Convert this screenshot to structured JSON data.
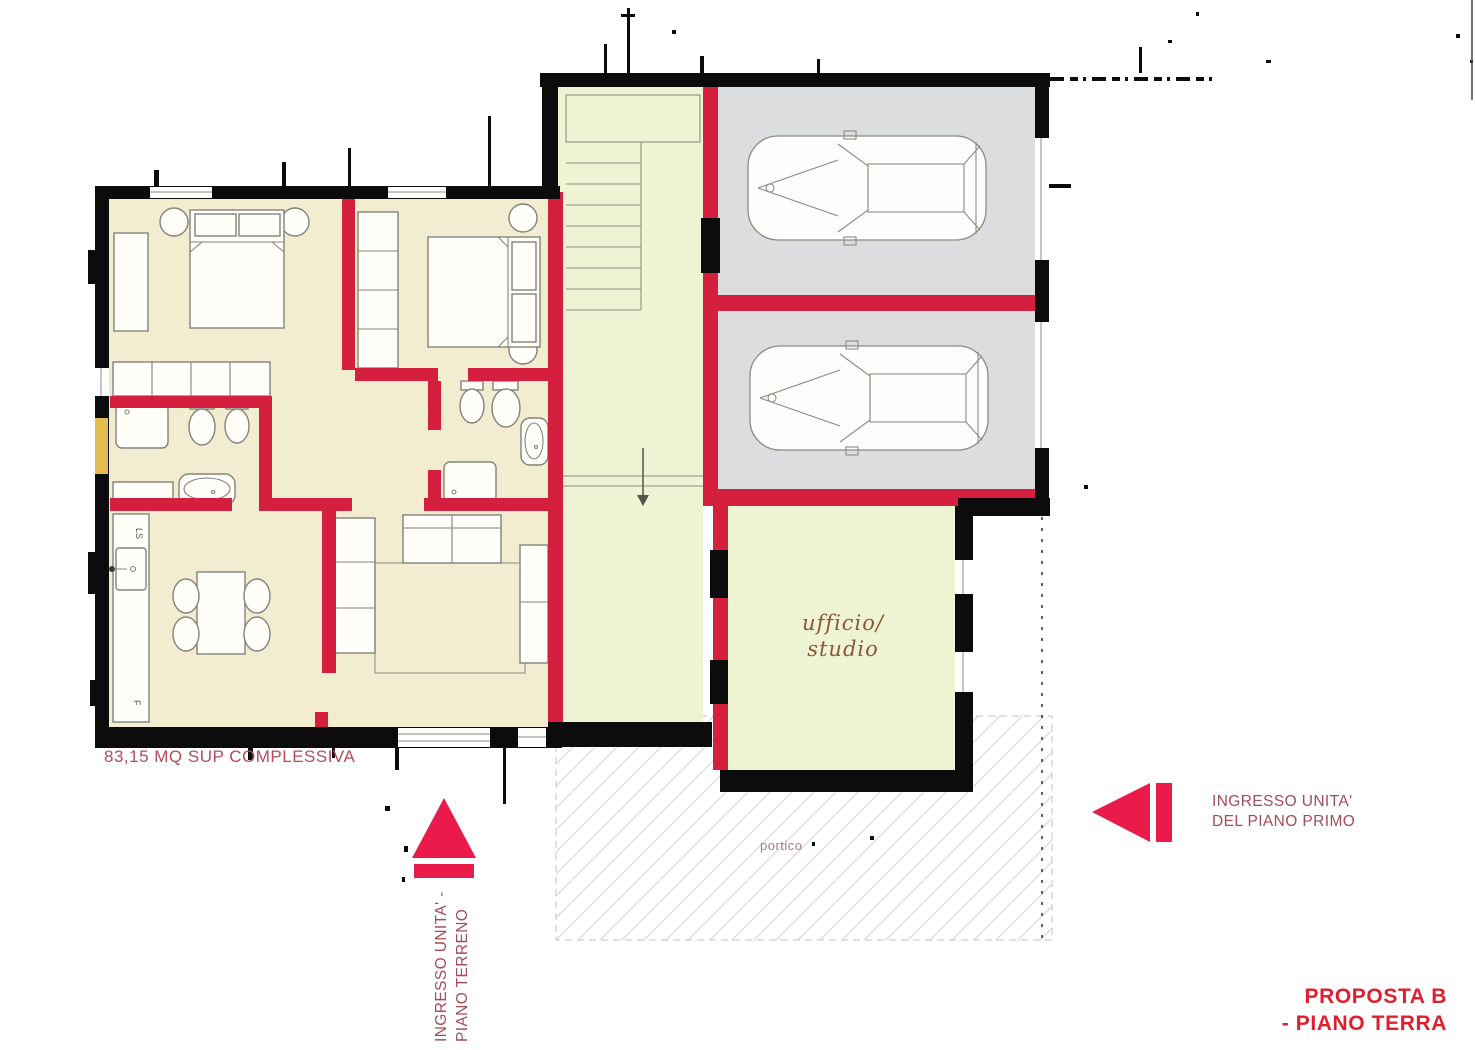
{
  "title": {
    "line1": "PROPOSTA  B",
    "line2": "- PIANO TERRA"
  },
  "labels": {
    "area_total": "83,15 MQ SUP COMPLESSIVA",
    "office_line1": "ufficio/",
    "office_line2": "studio",
    "portico": "portico",
    "entrance_first_floor_line1": "INGRESSO UNITA'",
    "entrance_first_floor_line2": "DEL PIANO PRIMO",
    "entrance_ground_floor_line1": "INGRESSO UNITA' -",
    "entrance_ground_floor_line2": "PIANO TERRENO",
    "kitchen_sink_label": "LS",
    "kitchen_fridge_label": "F"
  },
  "colors": {
    "wall_red": "#d51f3f",
    "arrow_red": "#ea1b4b",
    "apartment_cream": "#f2ecd1",
    "stair_green": "#eef3d4",
    "garage_gray": "#dcdddf",
    "title_red": "#e01f2e",
    "label_rust": "#a34b58",
    "area_text": "#b34b5a",
    "office_text": "#8a5738",
    "portico_text": "#a5798f",
    "door_yellow": "#e3bd4e"
  }
}
